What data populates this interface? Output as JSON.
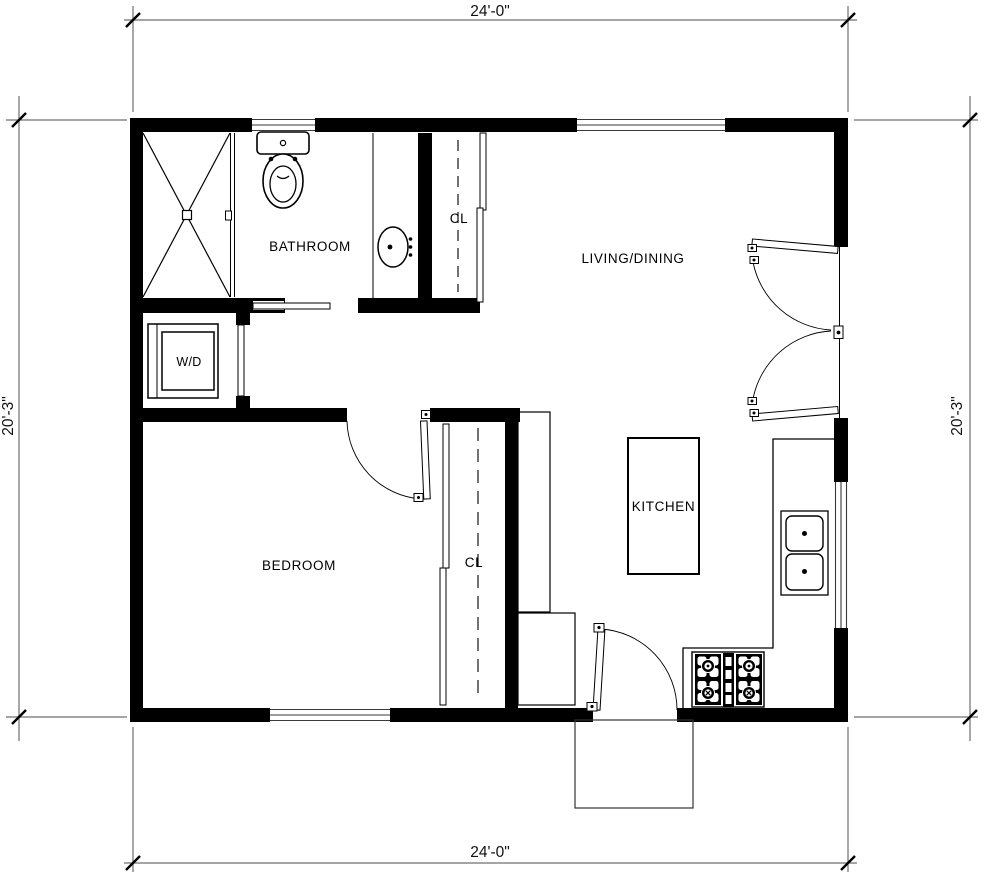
{
  "plan": {
    "rooms": {
      "bathroom": {
        "label": "BATHROOM"
      },
      "living_dining": {
        "label": "LIVING/DINING"
      },
      "bedroom": {
        "label": "BEDROOM"
      },
      "kitchen": {
        "label": "KITCHEN"
      },
      "closet_hall": {
        "label": "CL"
      },
      "closet_bedroom": {
        "label": "CL"
      },
      "laundry": {
        "label": "W/D"
      }
    },
    "dimensions": {
      "top": "24'-0\"",
      "bottom": "24'-0\"",
      "left": "20'-3\"",
      "right": "20'-3\""
    },
    "colors": {
      "wall": "#000000",
      "dimension_line": "#6f6f6f",
      "background": "#ffffff"
    }
  }
}
